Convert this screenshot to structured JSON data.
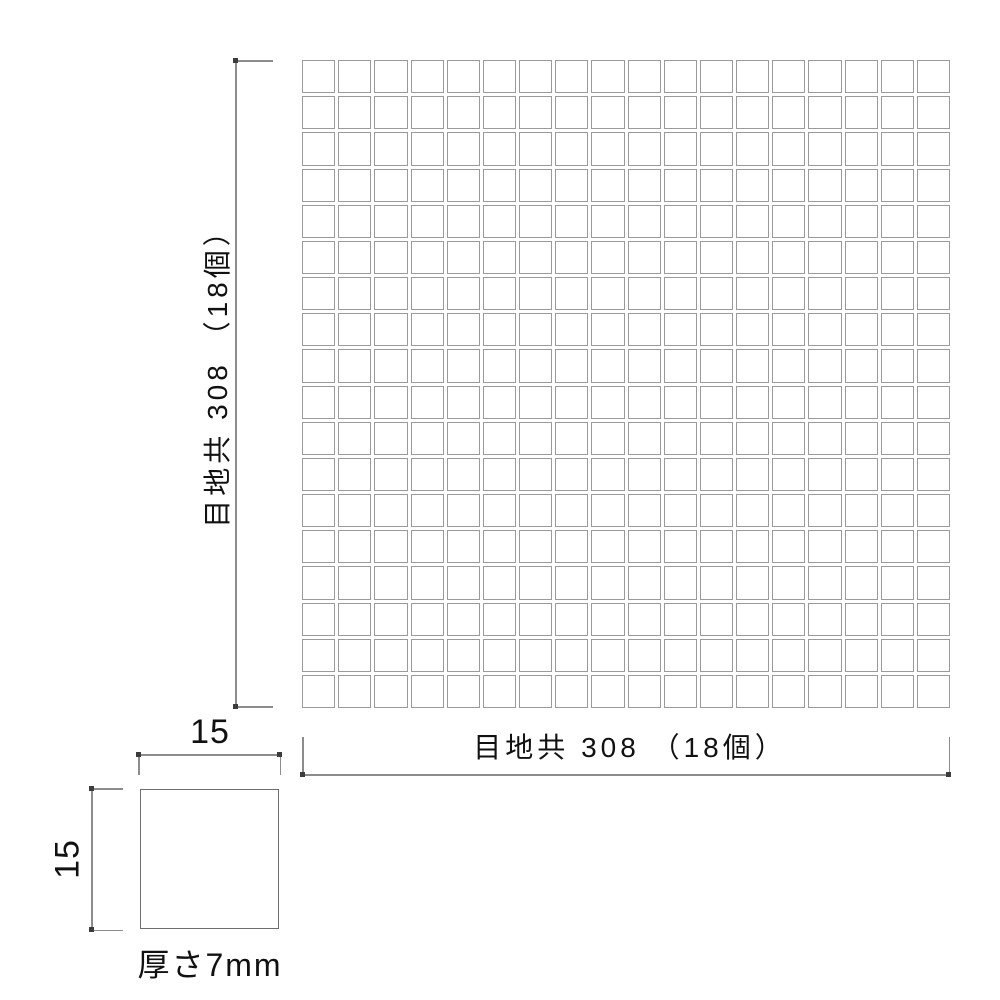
{
  "diagram": {
    "grid": {
      "rows": 18,
      "cols": 18
    },
    "dimensions": {
      "vertical_label": "目地共 308 （18個）",
      "horizontal_label": "目地共 308 （18個）",
      "tile_width_label": "15",
      "tile_height_label": "15",
      "thickness_label": "厚さ7mm"
    },
    "colors": {
      "background": "#ffffff",
      "dimension_line": "#8c8c8c",
      "tile_border": "#9a9a9a",
      "text": "#111111"
    }
  }
}
